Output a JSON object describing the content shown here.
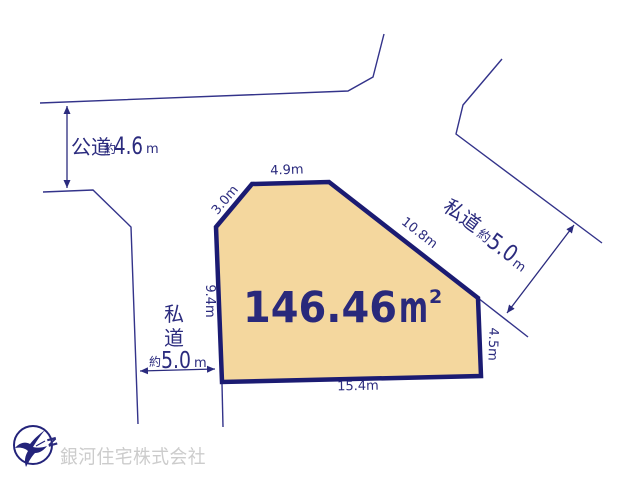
{
  "colors": {
    "line_navy": "#33338a",
    "text_navy": "#2b2b7e",
    "plot_fill": "#f4d79e",
    "plot_border": "#1b1b72",
    "watermark_gray": "#cccccc"
  },
  "plot": {
    "area": {
      "value": "146.46",
      "unit": "m",
      "sup": "2"
    },
    "edges": {
      "top_left": "3.0m",
      "top": "4.9m",
      "upper_right": "10.8m",
      "left": "9.4m",
      "lower_right": "4.5m",
      "bottom": "15.4m"
    }
  },
  "roads": {
    "public": {
      "name": "公道",
      "approx": "約",
      "value": "4.6",
      "unit": "m"
    },
    "private_left": {
      "name_char_1": "私",
      "name_char_2": "道",
      "approx": "約",
      "value": "5.0",
      "unit": "m"
    },
    "private_right": {
      "name": "私道",
      "approx": "約",
      "value": "5.0",
      "unit": "m"
    }
  },
  "compass": {
    "north": "N"
  },
  "watermark": "銀河住宅株式会社"
}
